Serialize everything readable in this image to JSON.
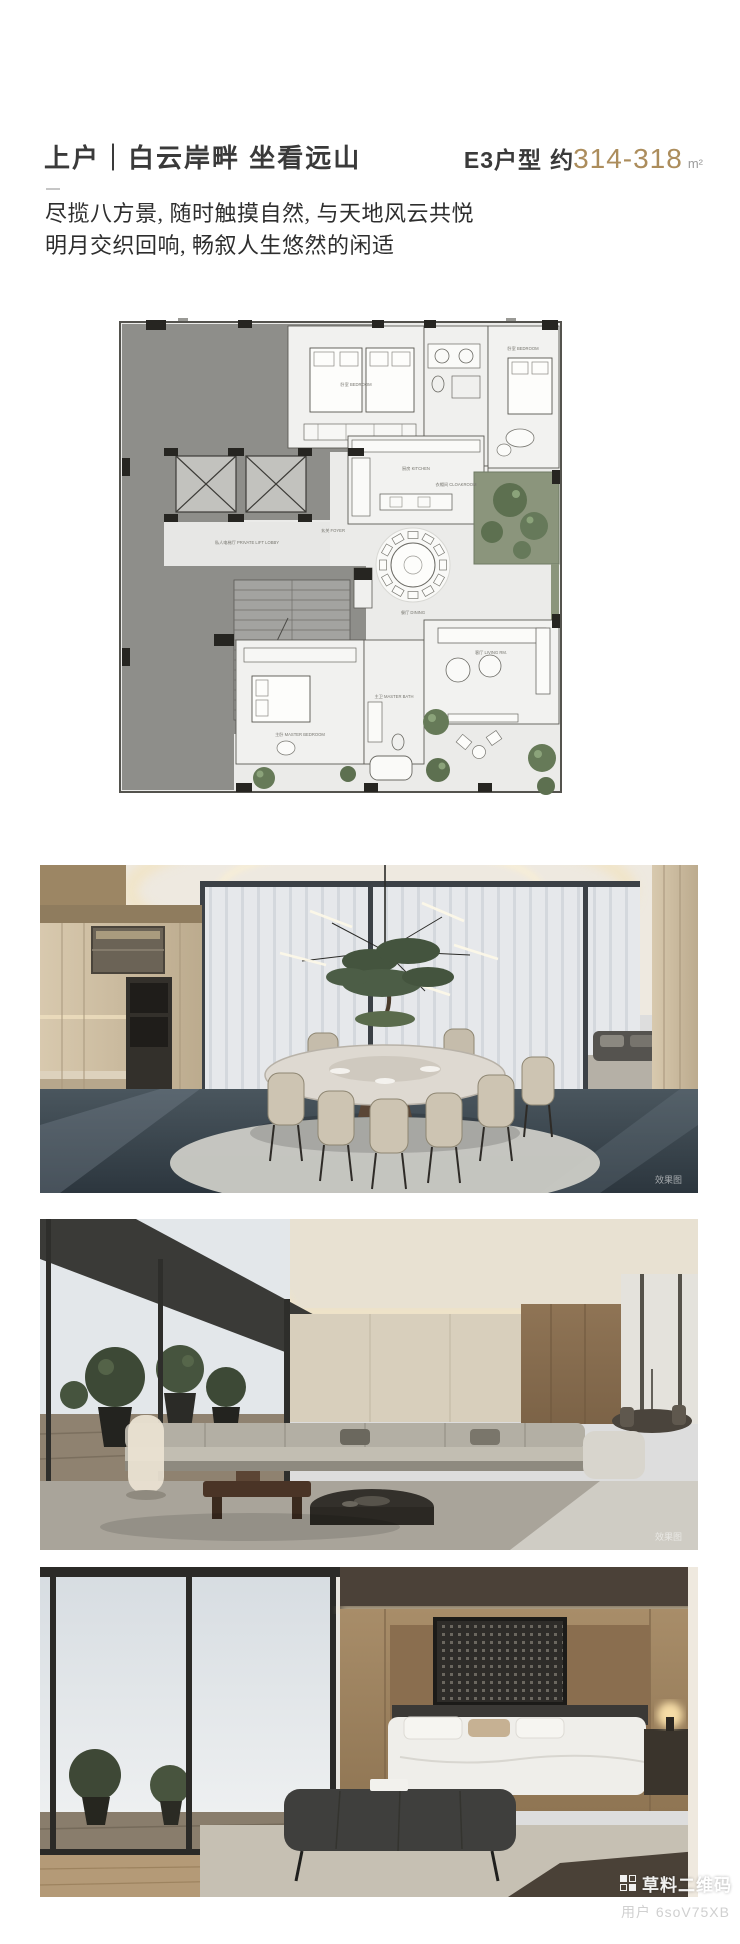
{
  "header": {
    "title": "上户｜白云岸畔 坐看远山",
    "unit": "E3户型",
    "approx": "约",
    "area": "314-318",
    "area_unit": "m²",
    "accent_color": "#ac8d5c"
  },
  "intro": {
    "line1": "尽揽八方景, 随时触摸自然, 与天地风云共悦",
    "line2": "明月交织回响, 畅叙人生悠然的闲适"
  },
  "floorplan": {
    "labels": {
      "lift_lobby": "私人电梯厅 PRIVATE LIFT LOBBY",
      "foyer": "玄关 FOYER",
      "kitchen": "厨房 KITCHEN",
      "dining": "餐厅 DINING",
      "living": "客厅 LIVING RM.",
      "bedroom": "卧室 BEDROOM",
      "bedroom2": "卧室 BEDROOM",
      "cloakroom": "衣帽间 CLOAKROOM",
      "master_bedroom": "主卧 MASTER BEDROOM",
      "master_bath": "主卫 MASTER BATH"
    }
  },
  "photos": [
    {
      "name": "dining-room-rendering",
      "tag": "效果图"
    },
    {
      "name": "living-room-rendering",
      "tag": "效果图"
    },
    {
      "name": "bedroom-rendering",
      "tag": ""
    }
  ],
  "watermark": {
    "brand": "草料二维码",
    "user": "用户 6soV75XB"
  }
}
